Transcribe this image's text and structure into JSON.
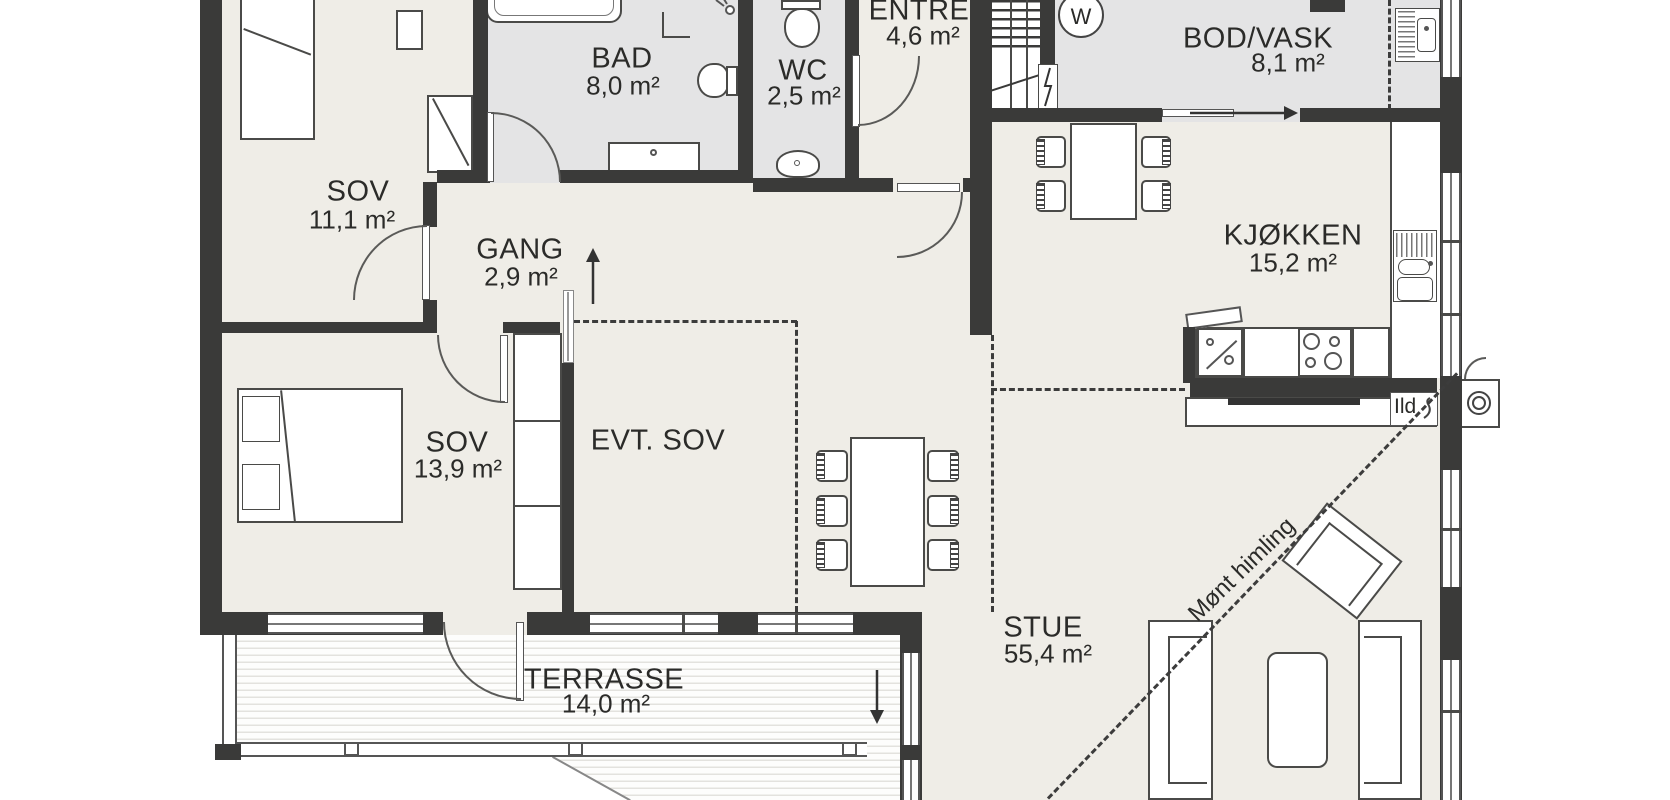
{
  "plan": {
    "rooms": {
      "sov1": {
        "name": "SOV",
        "area": "11,1 m²"
      },
      "bad": {
        "name": "BAD",
        "area": "8,0 m²"
      },
      "wc": {
        "name": "WC",
        "area": "2,5 m²"
      },
      "entre": {
        "name": "ENTRE",
        "area": "4,6 m²"
      },
      "bod": {
        "name": "BOD/VASK",
        "area": "8,1 m²"
      },
      "gang": {
        "name": "GANG",
        "area": "2,9 m²"
      },
      "kjokken": {
        "name": "KJØKKEN",
        "area": "15,2 m²"
      },
      "sov2": {
        "name": "SOV",
        "area": "13,9 m²"
      },
      "evtsov": {
        "name": "EVT. SOV",
        "area": ""
      },
      "stue": {
        "name": "STUE",
        "area": "55,4 m²"
      },
      "terrasse": {
        "name": "TERRASSE",
        "area": "14,0 m²"
      }
    },
    "annotations": {
      "ceiling": "Mønt himling",
      "fireplace": "Ild",
      "washer": "W"
    },
    "colors": {
      "wall": "#3a3a39",
      "floor": "#efede7",
      "wet_floor": "#e4e4e5",
      "background": "#ffffff"
    }
  }
}
